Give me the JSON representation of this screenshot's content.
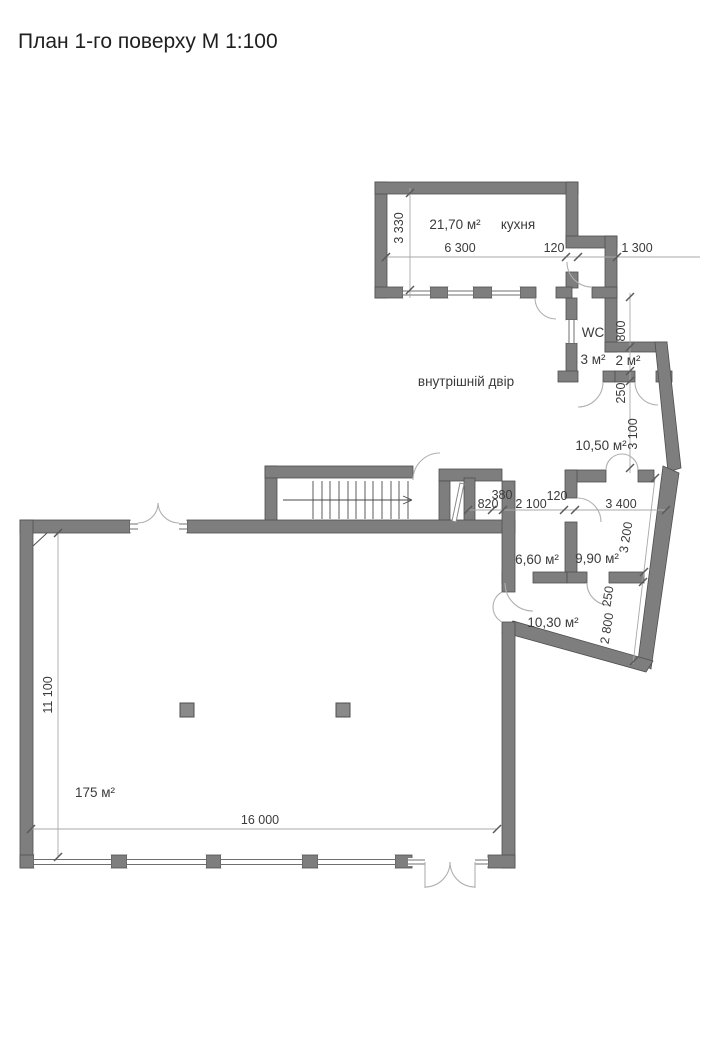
{
  "title": "План 1-го поверху М 1:100",
  "plan": {
    "rooms": {
      "kitchen": {
        "area": "21,70 м²",
        "name": "кухня"
      },
      "wc": {
        "name": "WC",
        "area": "3 м²"
      },
      "closet": {
        "area": "2 м²"
      },
      "room_1050": {
        "area": "10,50 м²"
      },
      "room_660": {
        "area": "6,60 м²"
      },
      "room_990": {
        "area": "9,90 м²"
      },
      "room_1030": {
        "area": "10,30 м²"
      },
      "hall": {
        "area": "175 м²"
      },
      "courtyard": {
        "label": "внутрішній двір"
      }
    },
    "dimensions": {
      "kitchen_height": "3 330",
      "kitchen_width": "6 300",
      "kitchen_door": "120",
      "annex_width": "1 300",
      "closet_height": "800",
      "wall_top": "250",
      "room_1050_height": "3 100",
      "shaft_width": "380",
      "closet_door": "820",
      "corridor_width": "2 100",
      "partition": "120",
      "hallway_width": "3 400",
      "slant_wall": "3 200",
      "wall_bottom": "250",
      "room_1030_height": "2 800",
      "hall_depth": "11 100",
      "hall_width": "16 000"
    },
    "colors": {
      "wall": "#7e7e7e",
      "wall_edge": "#4f4f4f",
      "thin_line": "#a8a8a8",
      "tick": "#5a5a5a",
      "text": "#3b3b3b",
      "background": "#ffffff"
    }
  }
}
